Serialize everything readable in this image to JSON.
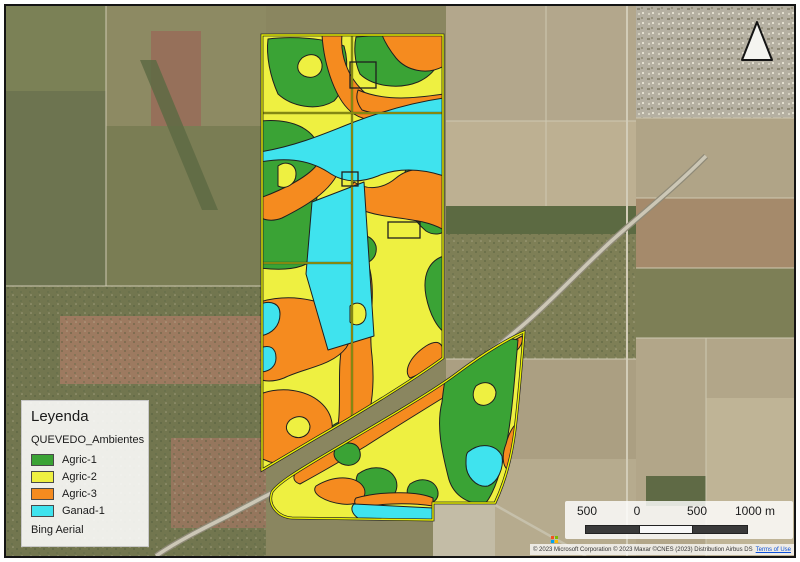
{
  "legend": {
    "title": "Leyenda",
    "layer_name": "QUEVEDO_Ambientes",
    "items": [
      {
        "key": "agric1",
        "label": "Agric-1",
        "color": "#3aa335"
      },
      {
        "key": "agric2",
        "label": "Agric-2",
        "color": "#eef041"
      },
      {
        "key": "agric3",
        "label": "Agric-3",
        "color": "#f58b1f"
      },
      {
        "key": "ganad1",
        "label": "Ganad-1",
        "color": "#3fe3ee"
      }
    ],
    "basemap_label": "Bing Aerial"
  },
  "scalebar": {
    "labels": [
      "500",
      "0",
      "500",
      "1000 m"
    ],
    "segment_colors": [
      "#3a3a3a",
      "#f7f7f7",
      "#3a3a3a"
    ]
  },
  "attribution": {
    "text": "© 2023 Microsoft Corporation © 2023 Maxar ©CNES (2023) Distribution Airbus DS",
    "link_label": "Terms of Use",
    "logo_colors": [
      "#f25022",
      "#7fba00",
      "#00a4ef",
      "#ffb900"
    ]
  },
  "overlay": {
    "outline_color": "#e9f104",
    "boundary_color": "#1f1f1f"
  }
}
